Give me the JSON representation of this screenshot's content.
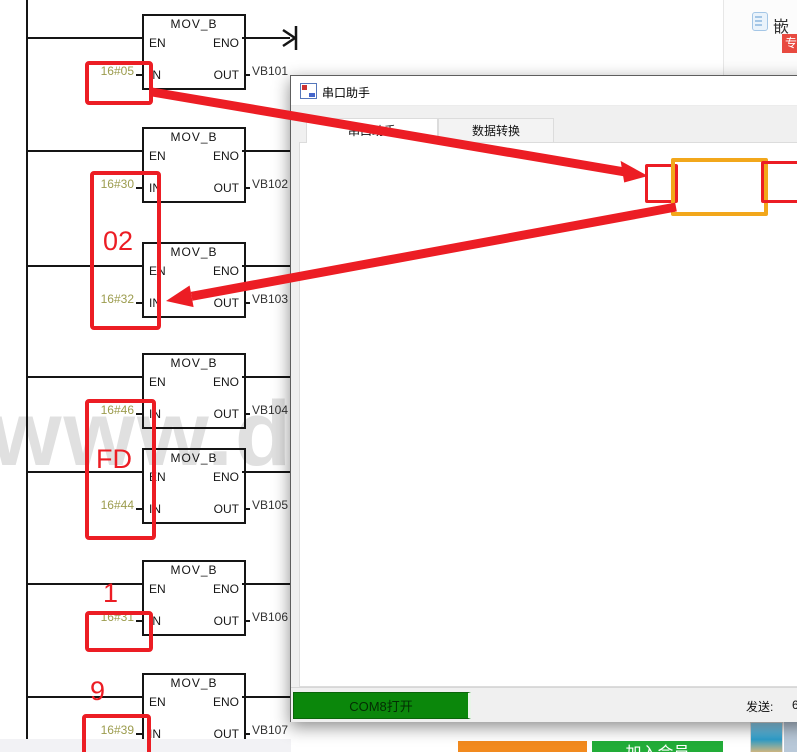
{
  "colors": {
    "annotation_red": "#ec1d24",
    "annotation_yellow": "#f2a71b",
    "value_olive": "#9c9c4e",
    "open_button_green": "#0b870b",
    "join_button_green": "#22ac38",
    "orange_button": "#f28a1e",
    "badge_red": "#e84a40"
  },
  "watermark": "www.doc",
  "ladder": {
    "block_title": "MOV_B",
    "en": "EN",
    "eno": "ENO",
    "in": "IN",
    "out": "OUT",
    "blocks": [
      {
        "top": 14,
        "value": "16#05",
        "output": "VB101"
      },
      {
        "top": 127,
        "value": "16#30",
        "output": "VB102"
      },
      {
        "top": 242,
        "value": "16#32",
        "output": "VB103"
      },
      {
        "top": 353,
        "value": "16#46",
        "output": "VB104"
      },
      {
        "top": 448,
        "value": "16#44",
        "output": "VB105"
      },
      {
        "top": 560,
        "value": "16#31",
        "output": "VB106"
      },
      {
        "top": 673,
        "value": "16#39",
        "output": "VB107"
      }
    ]
  },
  "annotations": {
    "boxes": [
      {
        "x": 85,
        "y": 61,
        "w": 60,
        "h": 36
      },
      {
        "x": 90,
        "y": 171,
        "w": 63,
        "h": 151,
        "label": "02",
        "label_x": 103,
        "label_y": 226
      },
      {
        "x": 85,
        "y": 399,
        "w": 63,
        "h": 133,
        "label": "FD",
        "label_x": 96,
        "label_y": 444
      },
      {
        "x": 85,
        "y": 611,
        "w": 60,
        "h": 33,
        "label": "1",
        "label_x": 103,
        "label_y": 578
      },
      {
        "x": 82,
        "y": 714,
        "w": 61,
        "h": 34,
        "label": "9",
        "label_x": 90,
        "label_y": 676
      }
    ],
    "message_boxes": [
      {
        "x": 645,
        "y": 164,
        "w": 27,
        "h": 33,
        "c": "red"
      },
      {
        "x": 671,
        "y": 158,
        "w": 89,
        "h": 50,
        "c": "yellow"
      },
      {
        "x": 761,
        "y": 161,
        "w": 34,
        "h": 36,
        "c": "red"
      }
    ]
  },
  "dialog": {
    "title": "串口助手",
    "tabs": [
      {
        "label": "串口助手"
      },
      {
        "label": "数据转换"
      }
    ],
    "serial_group": {
      "title": "串口设置",
      "fields": [
        {
          "label": "串口:",
          "value": "COM8"
        },
        {
          "label": "波特率:",
          "value": "9600"
        },
        {
          "label": "数据位:",
          "value": "8"
        },
        {
          "label": "停止位:",
          "value": "One"
        },
        {
          "label": "校验位:",
          "value": "None"
        }
      ]
    },
    "message_panel": {
      "title": "消息窗口",
      "log": "2024/01/26 01:42:15: 发送: 05 02 FD 01 96 96 F6 2C"
    },
    "send_group": {
      "title": "发送设置",
      "ascii": "ASCII",
      "hex": "HEX",
      "auto_send": "自动发送",
      "interval": "500",
      "ms": "ms",
      "crc": "附加CRC",
      "show0x": "显示\"0x\"",
      "ascii_checked": false,
      "hex_checked": true,
      "auto_checked": false,
      "crc_checked": true,
      "show0x_checked": false
    },
    "recv_group": {
      "title": "接收设置",
      "ascii": "ASCII",
      "hex": "HEX",
      "wrap": "自动换行",
      "show_send": "显示发送",
      "show_time": "显示时间",
      "ascii_checked": false,
      "hex_checked": true,
      "wrap_checked": true,
      "show_send_checked": true,
      "show_time_checked": true
    },
    "send_input": "05 02 fd 01 96 96",
    "open_button": "COM8打开",
    "status": {
      "send_label": "发送:",
      "send_value": "6"
    }
  },
  "page_chrome": {
    "top_right_text": "嵌",
    "top_right_badge": "专",
    "join_button": "加入会员"
  }
}
